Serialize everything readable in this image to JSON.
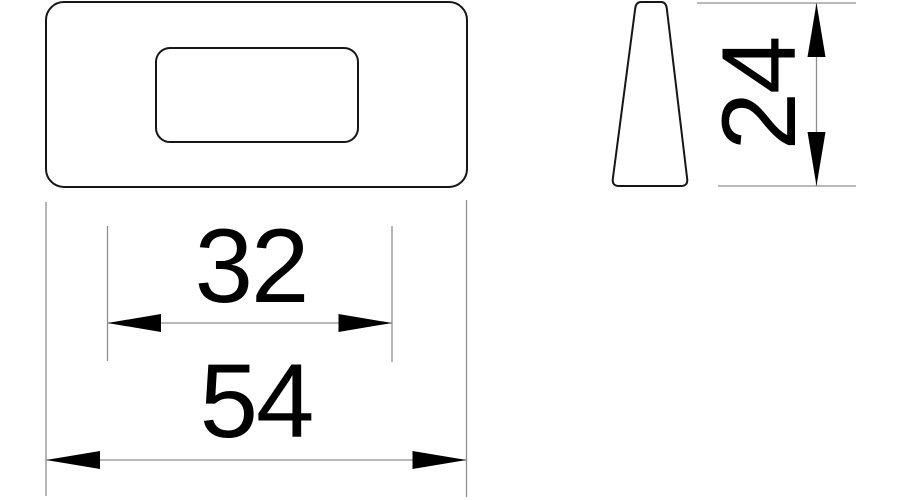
{
  "drawing": {
    "dimensions": {
      "slot_width": "32",
      "overall_width": "54",
      "height": "24"
    },
    "colors": {
      "outline": "#161616",
      "dimension_line": "#8f8f8f",
      "arrowhead": "#000000",
      "dimension_text": "#000000",
      "background": "#ffffff"
    }
  }
}
